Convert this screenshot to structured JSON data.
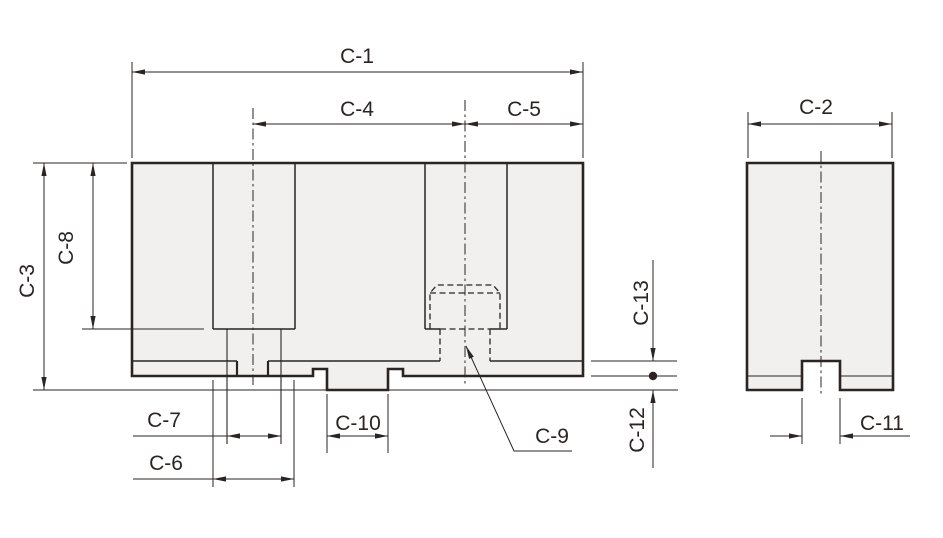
{
  "drawing": {
    "description": "Soft jaw dimension drawing, front and side views",
    "labels": {
      "c1": "C-1",
      "c2": "C-2",
      "c3": "C-3",
      "c4": "C-4",
      "c5": "C-5",
      "c6": "C-6",
      "c7": "C-7",
      "c8": "C-8",
      "c9": "C-9",
      "c10": "C-10",
      "c11": "C-11",
      "c12": "C-12",
      "c13": "C-13"
    },
    "colors": {
      "line": "#2a2422",
      "fill": "#f1f0ee",
      "background": "#ffffff"
    }
  }
}
